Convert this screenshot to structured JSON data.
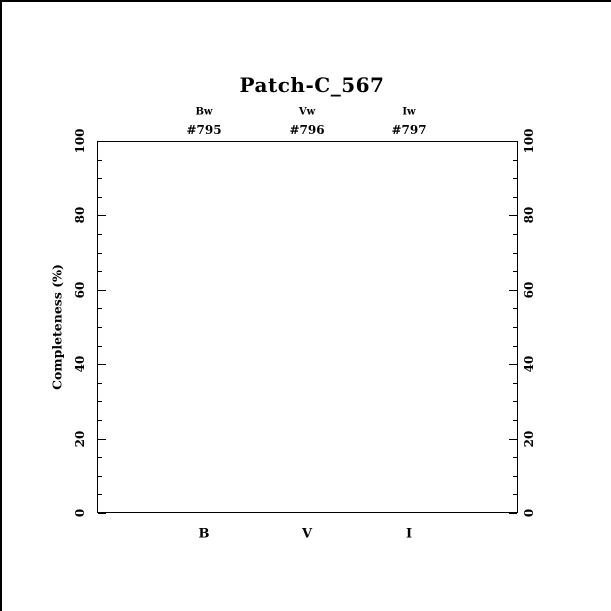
{
  "window": {
    "background_color": "#ffffff",
    "border_color": "#000000",
    "foreground_color": "#000000"
  },
  "chart_data": {
    "type": "line",
    "title": "Patch-C_567",
    "xlabel": "",
    "ylabel": "Completeness (%)",
    "ylim": [
      0,
      100
    ],
    "yticks_major": [
      0,
      20,
      40,
      60,
      80,
      100
    ],
    "ytick_minor_step": 5,
    "ytick_labels_rotated": true,
    "grid": "off",
    "frame": "box",
    "tick_sides": [
      "left",
      "right"
    ],
    "legend": "none",
    "series": [],
    "columns": [
      {
        "filter": "Bw",
        "run_id": "#795",
        "band": "B",
        "x_frac": 0.253
      },
      {
        "filter": "Vw",
        "run_id": "#796",
        "band": "V",
        "x_frac": 0.499
      },
      {
        "filter": "Iw",
        "run_id": "#797",
        "band": "I",
        "x_frac": 0.742
      }
    ]
  }
}
